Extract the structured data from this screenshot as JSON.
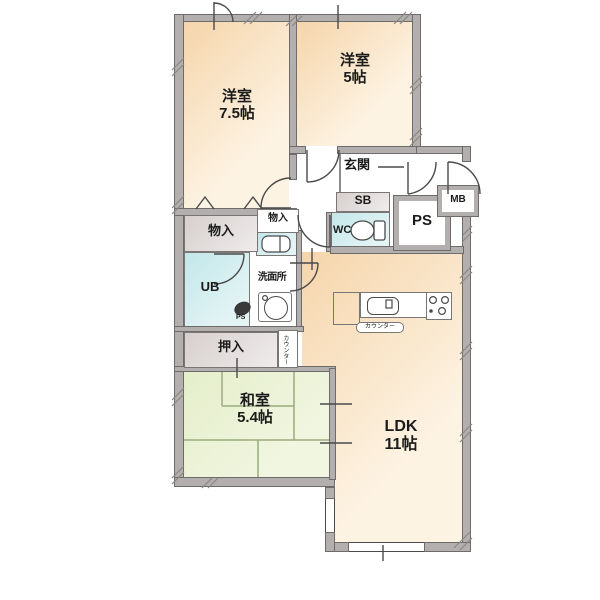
{
  "floorplan": {
    "rooms": {
      "western_room_75": {
        "name": "洋室",
        "size": "7.5帖"
      },
      "western_room_5": {
        "name": "洋室",
        "size": "5帖"
      },
      "entrance": {
        "name": "玄関"
      },
      "shoe_box": {
        "name": "SB"
      },
      "pipe_space": {
        "name": "PS"
      },
      "meter_box": {
        "name": "MB"
      },
      "toilet": {
        "name": "WC"
      },
      "storage_1": {
        "name": "物入"
      },
      "storage_2": {
        "name": "物入"
      },
      "unit_bath": {
        "name": "UB"
      },
      "washroom": {
        "name": "洗面所"
      },
      "pipe_space_2": {
        "name": "PS"
      },
      "closet": {
        "name": "押入"
      },
      "counter_side": {
        "name": "カウンター"
      },
      "counter_kitchen": {
        "name": "カウンター"
      },
      "japanese_room": {
        "name": "和室",
        "size": "5.4帖"
      },
      "ldk": {
        "name": "LDK",
        "size": "11帖"
      }
    },
    "palette": {
      "wall": "#b3afae",
      "wall_edge": "#6e6b6b",
      "peach": "#f5d5ab",
      "peach_light": "#fdf3e3",
      "green": "#e5eecb",
      "green_light": "#f1f6e0",
      "blue": "#c3e7ea",
      "blue_light": "#e4f4f5",
      "gray_box": "#d6cfce",
      "gray_box_light": "#efeceb",
      "line": "#4a4a4a",
      "tatami_line": "#9aaa7c",
      "text": "#1b1b1b"
    }
  }
}
